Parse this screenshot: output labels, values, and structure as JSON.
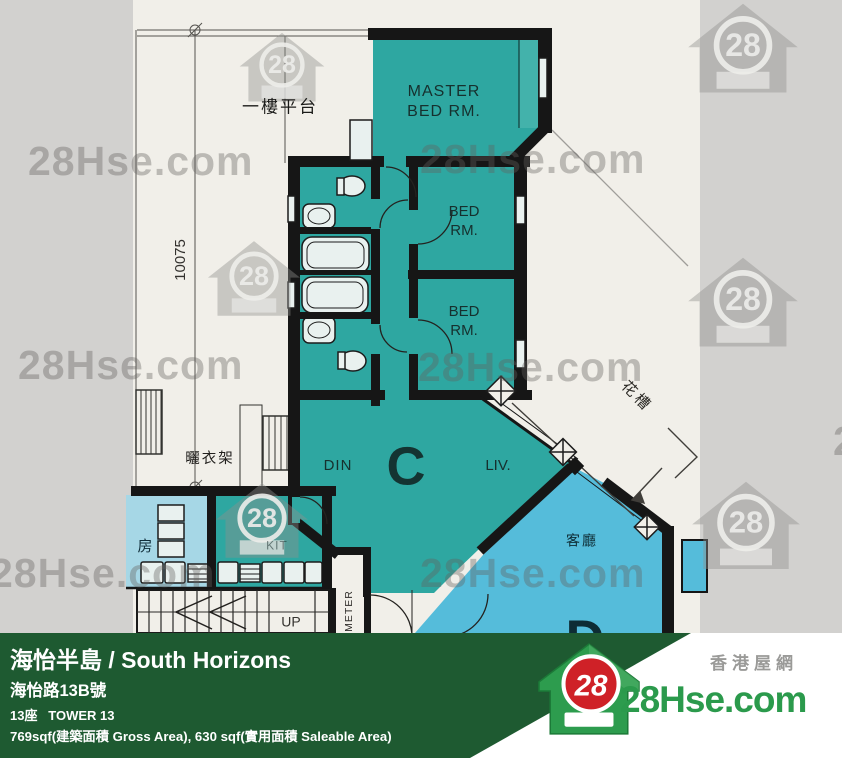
{
  "plan": {
    "platform_label": "一樓平台",
    "dimension": "10075",
    "drying_rack_label": "曬衣架",
    "master_bedroom": {
      "l1": "MASTER",
      "l2": "BED RM."
    },
    "bedrooms": [
      {
        "l1": "BED",
        "l2": "RM."
      },
      {
        "l1": "BED",
        "l2": "RM."
      }
    ],
    "dining_label": "DIN",
    "living_label": "LIV.",
    "unit_c": "C",
    "unit_d": "D",
    "planter_label": "花槽",
    "living_room_cn": "客廳",
    "room_cn": "房",
    "kitchen_label": "KIT",
    "up_label": "UP",
    "meter_label": "METER"
  },
  "watermark": {
    "brand": "28Hse.com",
    "logo_number": "28"
  },
  "footer": {
    "title": "海怡半島 / South Horizons",
    "address": "海怡路13B號",
    "tower": "13座   TOWER 13",
    "area": "769sqf(建築面積 Gross Area), 630 sqf(實用面積 Saleable Area)",
    "logo": {
      "number": "28",
      "site": "28Hse.com",
      "site_cn": "香港屋網"
    }
  },
  "colors": {
    "unit_c": "#2ea7a1",
    "unit_d": "#55bcda",
    "room_light": "#a6d7e6",
    "paper": "#f1efe9",
    "band": "#d2d1cf",
    "footer_green": "#1e5a31",
    "logo_green": "#2b9a4c",
    "logo_red": "#cf2127"
  }
}
